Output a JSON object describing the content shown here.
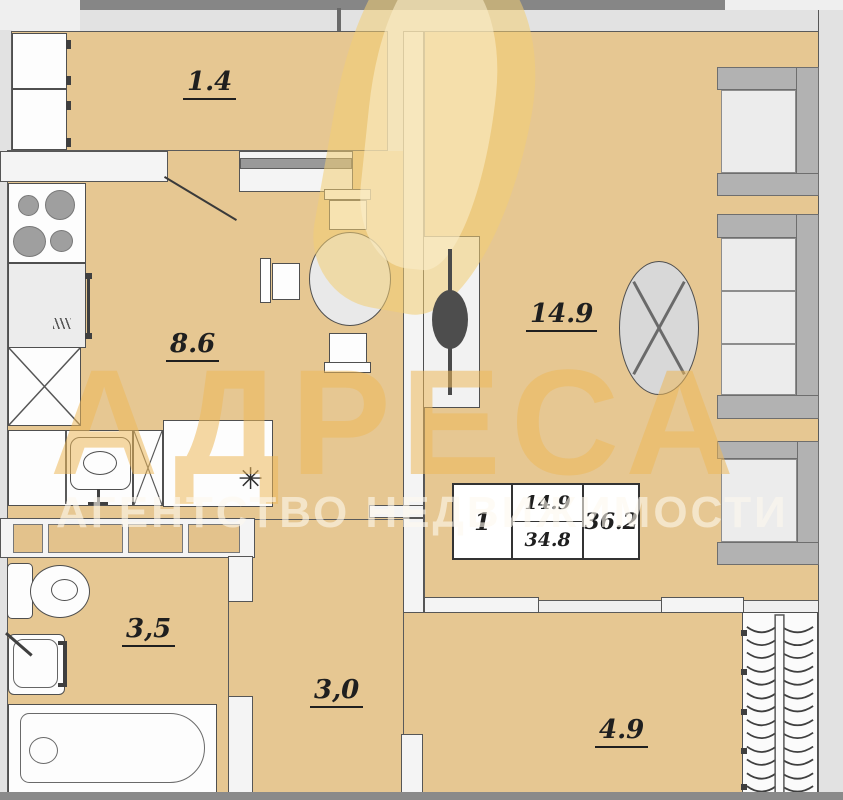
{
  "watermark": {
    "brand": "АДРЕСА",
    "subtitle": "агентство недвижимости"
  },
  "rooms": {
    "loggia": {
      "label": "1.4"
    },
    "kitchen": {
      "label": "8.6"
    },
    "living_room": {
      "label": "14.9"
    },
    "bathroom": {
      "label": "3,5"
    },
    "hallway": {
      "label": "3,0"
    },
    "dressing_room": {
      "label": "4.9"
    }
  },
  "info_table": {
    "rooms_count": "1",
    "living_area": "14.9",
    "extra_area": "34.8",
    "total_area": "36.2"
  },
  "icons": {
    "snowflake": "✳"
  },
  "colors": {
    "floor_tan": "#e6c792",
    "wall_fill": "#f4f4f4",
    "wall_dark_band": "#868686",
    "outline": "#4f4f4f",
    "furniture_gray": "#b2b2b2",
    "watermark_orange": "#ecb45a"
  }
}
